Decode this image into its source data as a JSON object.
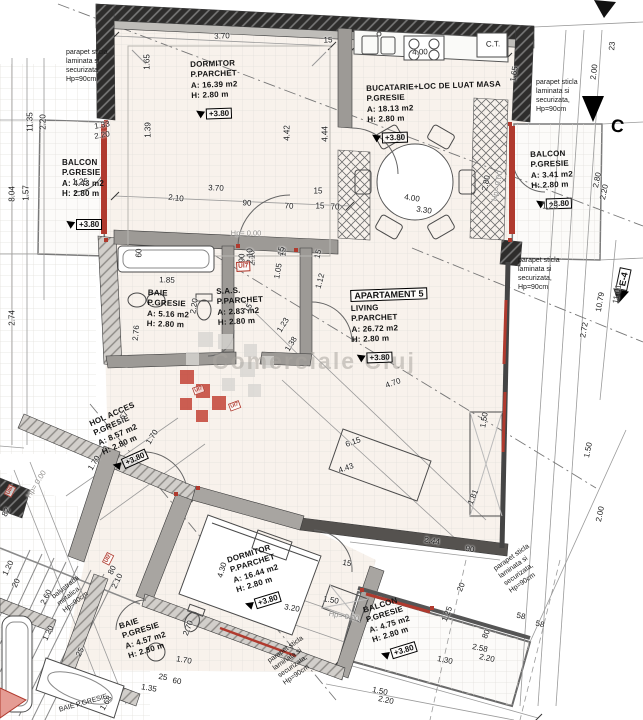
{
  "colors": {
    "accent_red": "#b03a2e",
    "wall_dark": "#2e2d2c",
    "wall_gray": "#8d8a86",
    "floor": "#f8f2ec",
    "watermark_gray": "#c9c5c0"
  },
  "watermark": {
    "text": "Comerciale Cluj"
  },
  "markers": {
    "section_c": {
      "label": "C"
    },
    "elevation": {
      "label": "E-4"
    },
    "units": [
      {
        "label": "UI7",
        "x": 236,
        "y": 262,
        "rot": -3,
        "s": 1
      },
      {
        "label": "UI7",
        "x": 192,
        "y": 388,
        "rot": -20,
        "s": 0.8
      },
      {
        "label": "UI7",
        "x": 228,
        "y": 404,
        "rot": -20,
        "s": 0.8
      },
      {
        "label": "UI2",
        "x": 102,
        "y": 562,
        "rot": -63,
        "s": 0.8
      },
      {
        "label": "UI6",
        "x": 4,
        "y": 494,
        "rot": -63,
        "s": 0.8
      }
    ]
  },
  "rooms": [
    {
      "id": "dormitor-1",
      "lines": [
        "DORMITOR",
        "P.PARCHET",
        "A: 16.39 m2",
        "H: 2.80 m"
      ],
      "level": "+3.80",
      "x": 190,
      "y": 60,
      "rot": -2
    },
    {
      "id": "bucatarie",
      "lines": [
        "BUCATARIE+LOC DE LUAT MASA",
        "P.GRESIE",
        "A: 18.13 m2",
        "H: 2.80 m"
      ],
      "level": "+3.80",
      "x": 366,
      "y": 84,
      "rot": -2
    },
    {
      "id": "balcon-vest",
      "lines": [
        "BALCON",
        "P.GRESIE",
        "A: 4.43 m2",
        "H: 2.80 m"
      ],
      "level": "+3.80",
      "x": 62,
      "y": 158,
      "rot": 0,
      "gap": 14
    },
    {
      "id": "balcon-est",
      "lines": [
        "BALCON",
        "P.GRESIE",
        "A: 3.41 m2",
        "H: 2.80 m"
      ],
      "level": "+3.80",
      "x": 530,
      "y": 150,
      "rot": -2
    },
    {
      "id": "baie-1",
      "lines": [
        "BAIE",
        "P.GRESIE",
        "A: 5.16 m2",
        "H: 2.80 m"
      ],
      "level": null,
      "x": 148,
      "y": 288,
      "rot": 2
    },
    {
      "id": "sas",
      "lines": [
        "S.A.S.",
        "P.PARCHET",
        "A: 2.83 m2",
        "H: 2.80 m"
      ],
      "level": null,
      "x": 216,
      "y": 287,
      "rot": -3
    },
    {
      "id": "living",
      "boxed_title": "APARTAMENT 5",
      "lines": [
        "LIVING",
        "P.PARCHET",
        "A: 26.72 m2",
        "H: 2.80 m"
      ],
      "level": "+3.80",
      "x": 350,
      "y": 286,
      "rot": -2
    },
    {
      "id": "hol-acces",
      "lines": [
        "HOL ACCES",
        "P.GRESIE",
        "A: 8.57 m2",
        "H: 2.80 m"
      ],
      "level": "+3.80",
      "x": 88,
      "y": 420,
      "rot": -24
    },
    {
      "id": "dormitor-2",
      "lines": [
        "DORMITOR",
        "P.PARCHET",
        "A: 16.44 m2",
        "H: 2.80 m"
      ],
      "level": "+3.80",
      "x": 226,
      "y": 556,
      "rot": -17
    },
    {
      "id": "baie-2",
      "lines": [
        "BAIE",
        "P.GRESIE",
        "A: 4.57 m2",
        "H: 2.80 m"
      ],
      "level": null,
      "x": 118,
      "y": 622,
      "rot": -17
    },
    {
      "id": "balcon-sud",
      "lines": [
        "BALCON",
        "P.GRESIE",
        "A: 4.75 m2",
        "H: 2.80 m"
      ],
      "level": "+3.80",
      "x": 362,
      "y": 606,
      "rot": -17
    }
  ],
  "notes": [
    {
      "text": "parapet sticla laminata si securizata, Hp=90cm",
      "x": 66,
      "y": 48,
      "w": 56,
      "rot": 0
    },
    {
      "text": "parapet sticla laminata si securizata, Hp=90cm",
      "x": 536,
      "y": 78,
      "w": 56,
      "rot": 0
    },
    {
      "text": "parapet sticla laminata si securizata, Hp=90cm",
      "x": 518,
      "y": 256,
      "w": 50,
      "rot": 0
    },
    {
      "text": "parapet sticla laminata si securizata, Hp=90cm",
      "x": 492,
      "y": 566,
      "w": 58,
      "rot": -35
    },
    {
      "text": "parapet sticla laminata si securizata, Hp=90cm",
      "x": 266,
      "y": 658,
      "w": 56,
      "rot": -35
    },
    {
      "text": "balustrada metalica Hp=90cm",
      "x": 50,
      "y": 594,
      "w": 46,
      "rot": -38
    },
    {
      "text": "BAIE  P.GRESIE",
      "x": 58,
      "y": 706,
      "w": 70,
      "rot": -16
    }
  ],
  "dims": [
    {
      "t": "3.70",
      "x": 222,
      "y": 36,
      "r": -2
    },
    {
      "t": "15",
      "x": 328,
      "y": 40,
      "r": -2
    },
    {
      "t": "4.00",
      "x": 420,
      "y": 52,
      "r": -2
    },
    {
      "t": "C.T.",
      "x": 493,
      "y": 44,
      "r": -2
    },
    {
      "t": "1.65",
      "x": 147,
      "y": 62,
      "r": -90
    },
    {
      "t": "1.65",
      "x": 514,
      "y": 74,
      "r": -80
    },
    {
      "t": "23",
      "x": 612,
      "y": 46,
      "r": -85
    },
    {
      "t": "2.00",
      "x": 594,
      "y": 72,
      "r": -83
    },
    {
      "t": "1.39",
      "x": 148,
      "y": 130,
      "r": -90
    },
    {
      "t": "4.42",
      "x": 287,
      "y": 133,
      "r": -90
    },
    {
      "t": "4.44",
      "x": 325,
      "y": 134,
      "r": -90
    },
    {
      "t": "11.35",
      "x": 30,
      "y": 122,
      "r": -90
    },
    {
      "t": "2.20",
      "x": 43,
      "y": 122,
      "r": -90
    },
    {
      "t": "8.04",
      "x": 12,
      "y": 194,
      "r": -90
    },
    {
      "t": "1.57",
      "x": 26,
      "y": 193,
      "r": -90
    },
    {
      "t": "2.74",
      "x": 12,
      "y": 318,
      "r": -90
    },
    {
      "t": "1.33",
      "x": 102,
      "y": 125,
      "r": -10
    },
    {
      "t": "2.20",
      "x": 102,
      "y": 135,
      "r": -10
    },
    {
      "t": "1.25",
      "x": 80,
      "y": 182,
      "r": 0
    },
    {
      "t": "3.70",
      "x": 216,
      "y": 188,
      "r": 2
    },
    {
      "t": "2.10",
      "x": 176,
      "y": 198,
      "r": 6
    },
    {
      "t": "90",
      "x": 247,
      "y": 203,
      "r": 3
    },
    {
      "t": "70",
      "x": 289,
      "y": 206,
      "r": 3
    },
    {
      "t": "15",
      "x": 318,
      "y": 191,
      "r": 0
    },
    {
      "t": "15",
      "x": 320,
      "y": 206,
      "r": 0
    },
    {
      "t": "70",
      "x": 335,
      "y": 207,
      "r": 0
    },
    {
      "t": "Hp= 0.00",
      "x": 246,
      "y": 233,
      "r": 0,
      "c": "g"
    },
    {
      "t": "90",
      "x": 242,
      "y": 258,
      "r": -90
    },
    {
      "t": "2.10",
      "x": 252,
      "y": 258,
      "r": -90
    },
    {
      "t": "15",
      "x": 283,
      "y": 252,
      "r": -90
    },
    {
      "t": "60",
      "x": 139,
      "y": 253,
      "r": -90
    },
    {
      "t": "1.85",
      "x": 167,
      "y": 280,
      "r": 2
    },
    {
      "t": "2.20",
      "x": 194,
      "y": 306,
      "r": -80
    },
    {
      "t": "2.76",
      "x": 136,
      "y": 333,
      "r": -85
    },
    {
      "t": "2.10",
      "x": 250,
      "y": 256,
      "r": -90
    },
    {
      "t": "1.05",
      "x": 278,
      "y": 271,
      "r": -80
    },
    {
      "t": "15",
      "x": 281,
      "y": 251,
      "r": -80
    },
    {
      "t": "15",
      "x": 318,
      "y": 254,
      "r": -75
    },
    {
      "t": "1.12",
      "x": 320,
      "y": 281,
      "r": -75
    },
    {
      "t": "15",
      "x": 248,
      "y": 308,
      "r": -58
    },
    {
      "t": "1.23",
      "x": 283,
      "y": 325,
      "r": -58
    },
    {
      "t": "1.38",
      "x": 291,
      "y": 344,
      "r": -58
    },
    {
      "t": "4.00",
      "x": 412,
      "y": 198,
      "r": 8
    },
    {
      "t": "3.30",
      "x": 424,
      "y": 210,
      "r": 8
    },
    {
      "t": "2.80",
      "x": 486,
      "y": 183,
      "r": -78
    },
    {
      "t": "Hp= 0.00",
      "x": 497,
      "y": 186,
      "r": -78,
      "c": "g"
    },
    {
      "t": "1.25",
      "x": 550,
      "y": 206,
      "r": 0
    },
    {
      "t": "2.80",
      "x": 597,
      "y": 180,
      "r": -78
    },
    {
      "t": "2.20",
      "x": 604,
      "y": 192,
      "r": -78
    },
    {
      "t": "4.70",
      "x": 393,
      "y": 383,
      "r": -20
    },
    {
      "t": "6.15",
      "x": 353,
      "y": 442,
      "r": -20
    },
    {
      "t": "4.43",
      "x": 346,
      "y": 468,
      "r": -20
    },
    {
      "t": "1.81",
      "x": 473,
      "y": 497,
      "r": -68
    },
    {
      "t": "2.44",
      "x": 432,
      "y": 541,
      "r": 10
    },
    {
      "t": "90",
      "x": 470,
      "y": 549,
      "r": 10
    },
    {
      "t": "1.50",
      "x": 484,
      "y": 420,
      "r": -80
    },
    {
      "t": "2.72",
      "x": 584,
      "y": 330,
      "r": -80
    },
    {
      "t": "10.79",
      "x": 600,
      "y": 302,
      "r": -80
    },
    {
      "t": "11.01",
      "x": 617,
      "y": 294,
      "r": -80
    },
    {
      "t": "1.50",
      "x": 588,
      "y": 450,
      "r": -78
    },
    {
      "t": "2.00",
      "x": 600,
      "y": 514,
      "r": -78
    },
    {
      "t": "1.70",
      "x": 152,
      "y": 437,
      "r": -58
    },
    {
      "t": "1.70",
      "x": 94,
      "y": 463,
      "r": -58
    },
    {
      "t": "4.67",
      "x": 122,
      "y": 418,
      "r": -58
    },
    {
      "t": "Hp= 0.00",
      "x": 36,
      "y": 484,
      "r": -58,
      "c": "g"
    },
    {
      "t": "4.30",
      "x": 222,
      "y": 570,
      "r": -74
    },
    {
      "t": "3.20",
      "x": 292,
      "y": 608,
      "r": 10
    },
    {
      "t": "1.50",
      "x": 331,
      "y": 600,
      "r": 10
    },
    {
      "t": "Hp= 0.00",
      "x": 344,
      "y": 616,
      "r": 10,
      "c": "g"
    },
    {
      "t": "15",
      "x": 347,
      "y": 563,
      "r": 10
    },
    {
      "t": "2.70",
      "x": 188,
      "y": 628,
      "r": -70
    },
    {
      "t": "1.70",
      "x": 184,
      "y": 660,
      "r": 10
    },
    {
      "t": "25",
      "x": 163,
      "y": 677,
      "r": 10
    },
    {
      "t": "60",
      "x": 177,
      "y": 681,
      "r": 10
    },
    {
      "t": "1.35",
      "x": 149,
      "y": 688,
      "r": 10
    },
    {
      "t": "1.68",
      "x": 106,
      "y": 703,
      "r": -58
    },
    {
      "t": "25",
      "x": 80,
      "y": 652,
      "r": -64
    },
    {
      "t": "1.20",
      "x": 48,
      "y": 633,
      "r": -64
    },
    {
      "t": "2.60",
      "x": 46,
      "y": 597,
      "r": -64
    },
    {
      "t": "20",
      "x": 16,
      "y": 583,
      "r": -64
    },
    {
      "t": "1.20",
      "x": 8,
      "y": 568,
      "r": -64
    },
    {
      "t": "82",
      "x": 6,
      "y": 512,
      "r": -64
    },
    {
      "t": "80",
      "x": 112,
      "y": 570,
      "r": -64
    },
    {
      "t": "2.10",
      "x": 117,
      "y": 581,
      "r": -64
    },
    {
      "t": "1.25",
      "x": 447,
      "y": 614,
      "r": -68
    },
    {
      "t": "80",
      "x": 486,
      "y": 634,
      "r": -68
    },
    {
      "t": "20",
      "x": 461,
      "y": 587,
      "r": -68
    },
    {
      "t": "1.30",
      "x": 445,
      "y": 660,
      "r": 12
    },
    {
      "t": "1.50",
      "x": 380,
      "y": 691,
      "r": 12
    },
    {
      "t": "2.20",
      "x": 386,
      "y": 700,
      "r": 12
    },
    {
      "t": "2.58",
      "x": 480,
      "y": 648,
      "r": 12
    },
    {
      "t": "2.20",
      "x": 487,
      "y": 658,
      "r": 12
    },
    {
      "t": "58",
      "x": 521,
      "y": 616,
      "r": 12
    },
    {
      "t": "58",
      "x": 540,
      "y": 624,
      "r": 12
    }
  ]
}
